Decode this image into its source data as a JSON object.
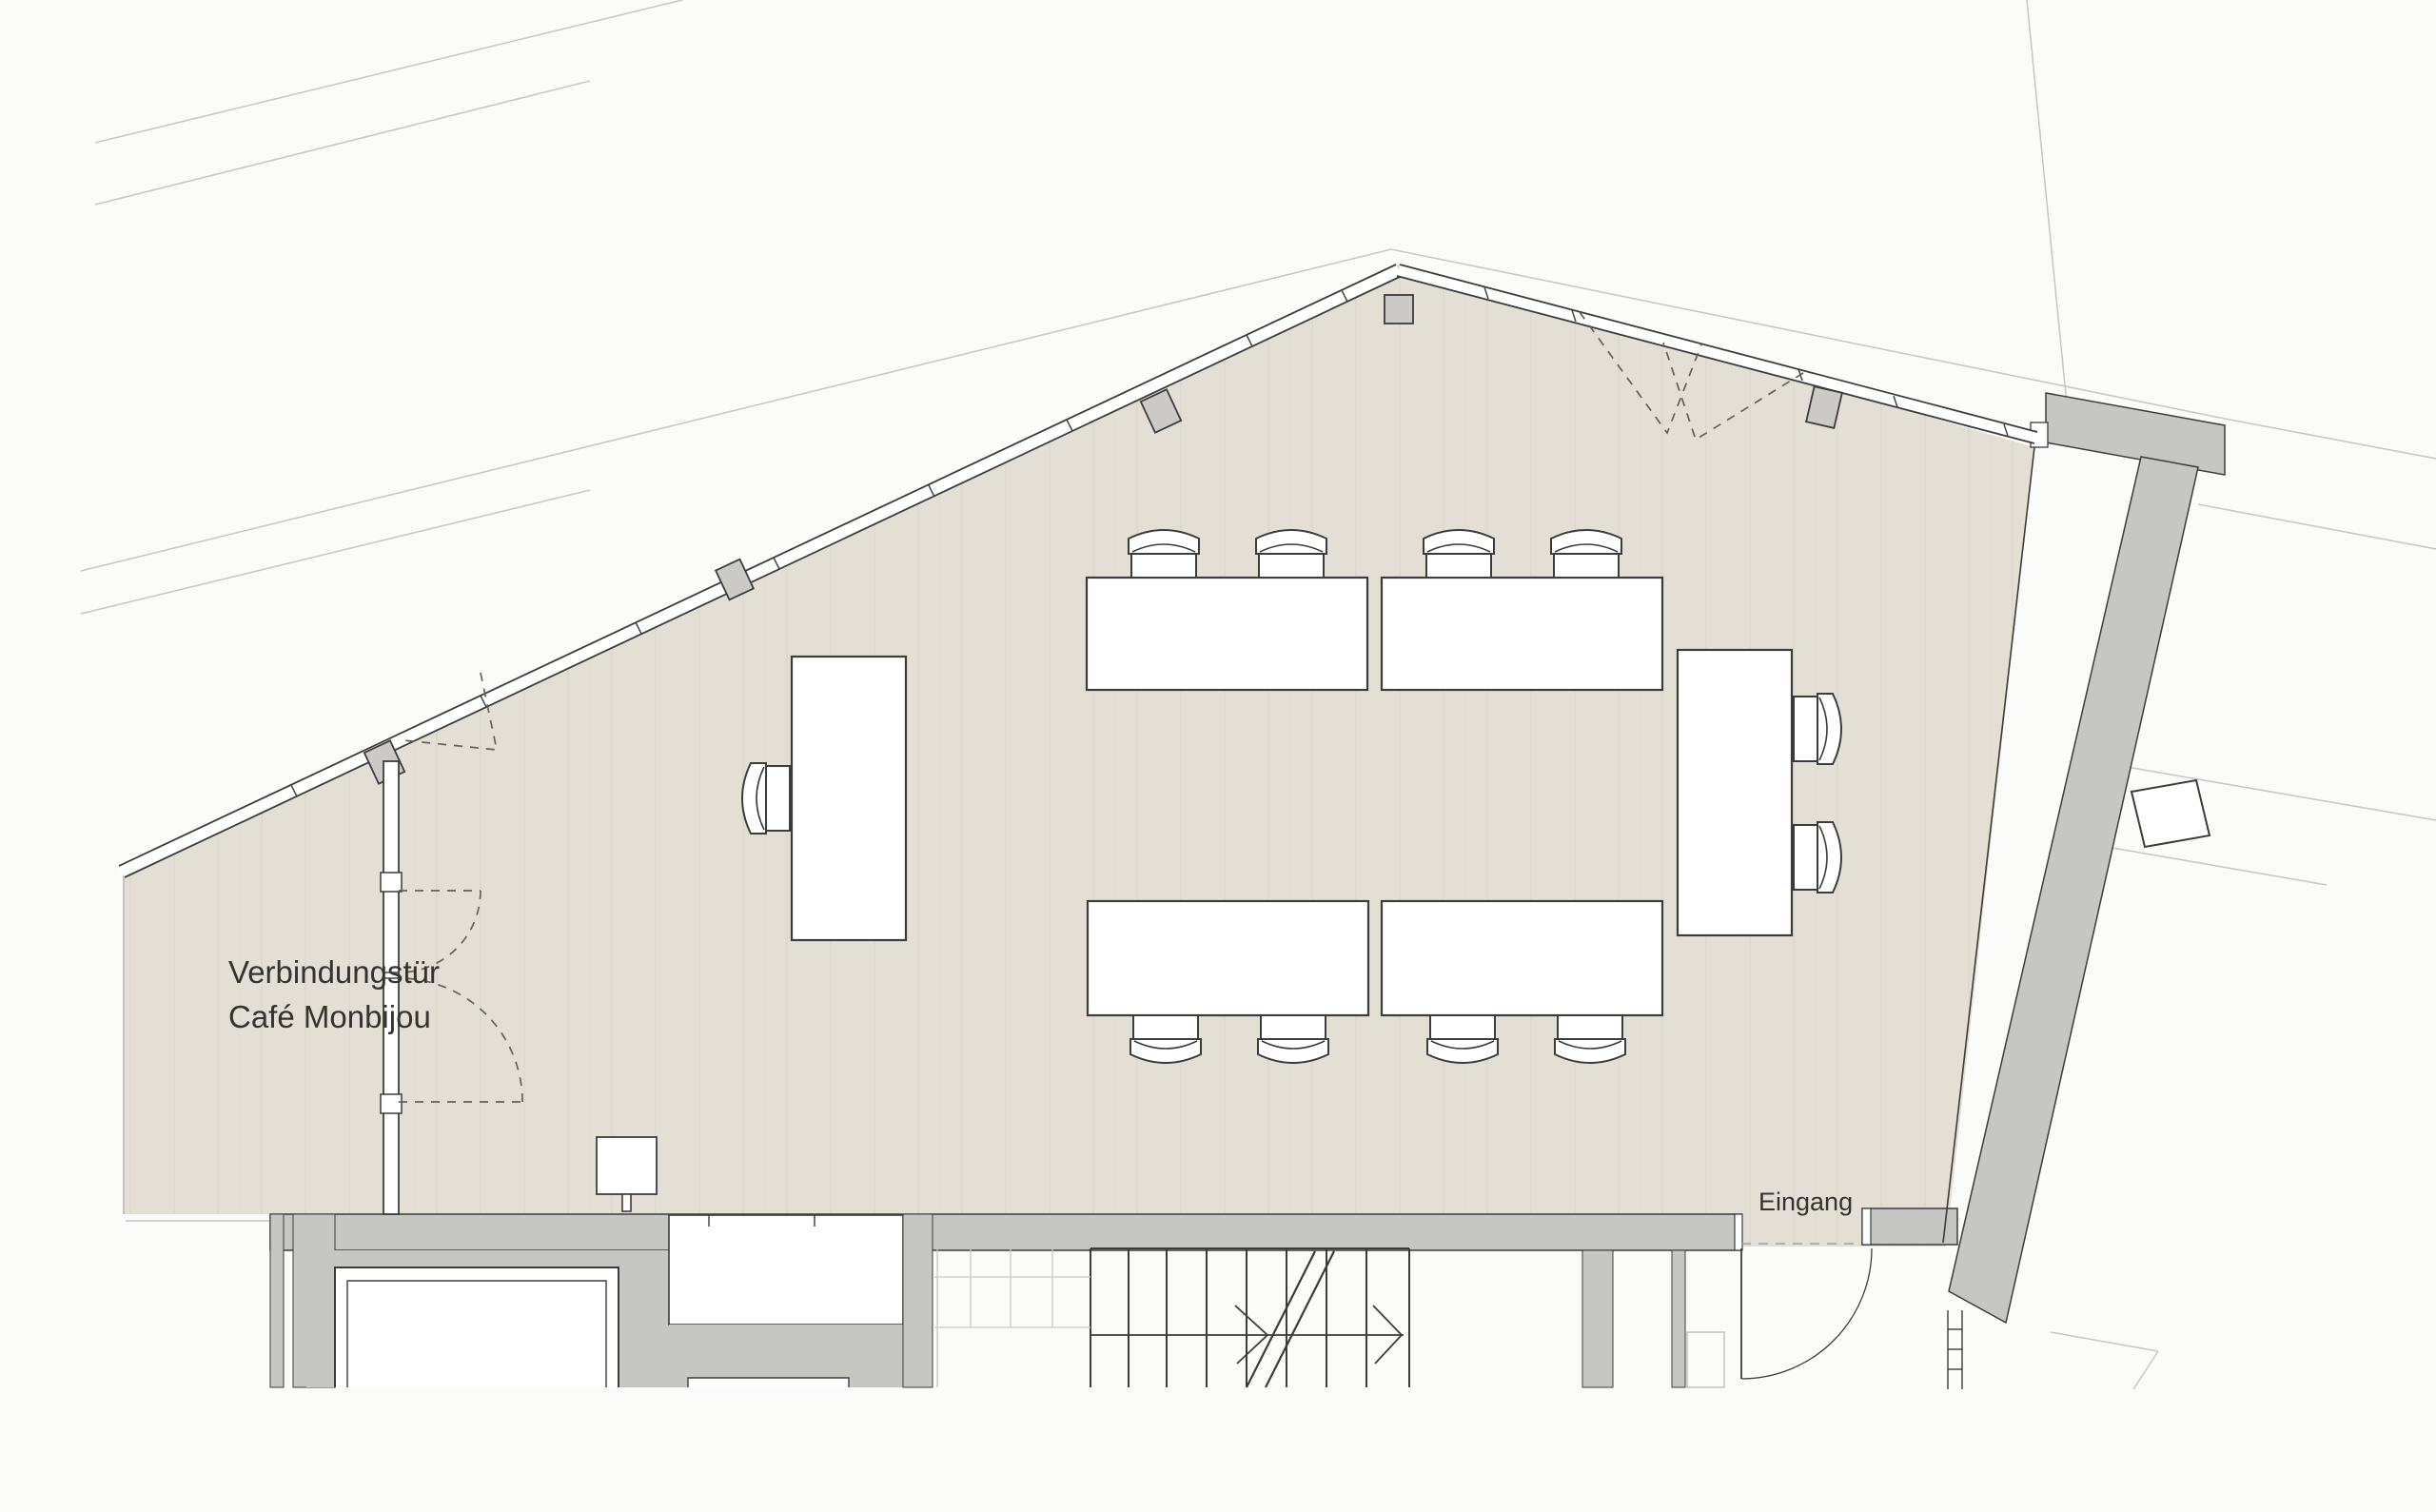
{
  "plan": {
    "kind": "architectural-floor-plan-scan",
    "labels": {
      "connecting_door_line1": "Verbindungstür",
      "connecting_door_line2": "Café Monbijou",
      "entrance": "Eingang"
    },
    "colors": {
      "paper": "#fbfbfa",
      "floor": "#e3dfd4",
      "floor_stripe": "#d8d4c8",
      "wall_gray": "#c6c6c3",
      "column_gray": "#cbcac7",
      "line_ink": "#3c3c3a",
      "faint_line": "#c9c9c4",
      "door_dash": "#6a5d55",
      "label_text": "#33332f"
    }
  }
}
